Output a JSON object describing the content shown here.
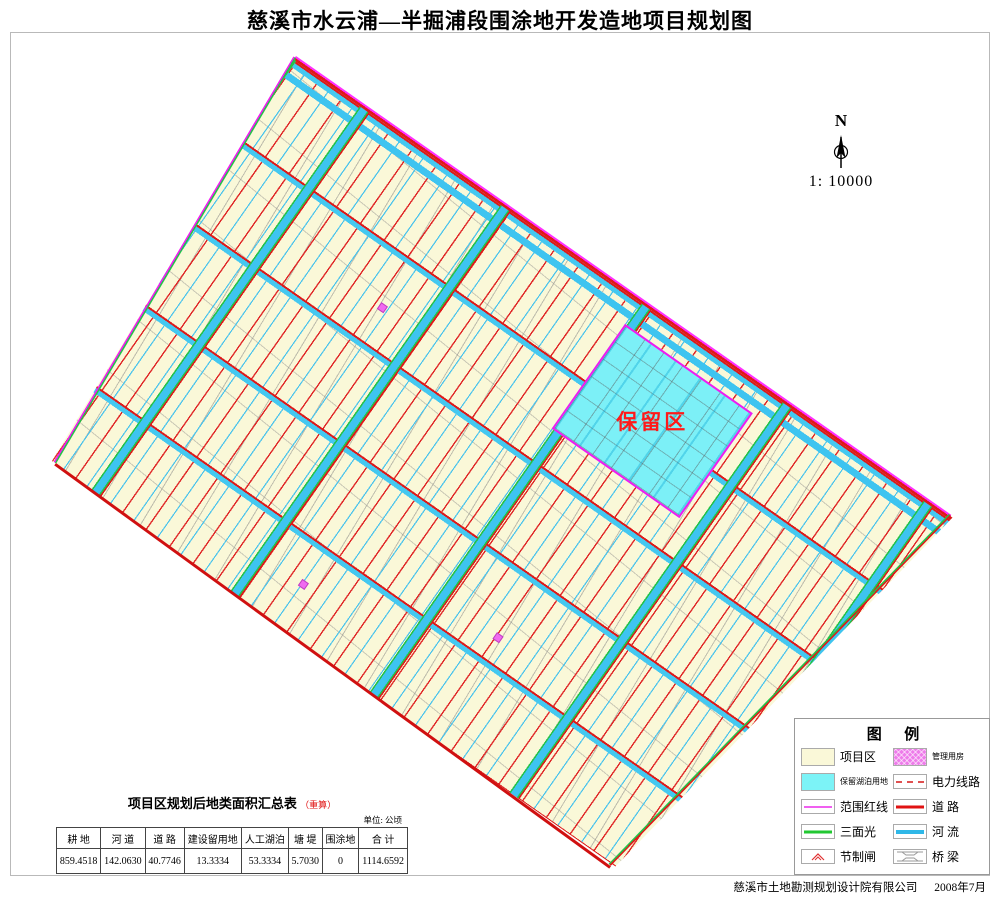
{
  "title": "慈溪市水云浦—半掘浦段围涂地开发造地项目规划图",
  "map": {
    "north_label": "N",
    "scale_text": "1: 10000",
    "reserved_area_label": "保留区",
    "colors": {
      "project_area_fill": "#faf8d8",
      "reserved_area_fill": "#7cf0f7",
      "road_line": "#e01212",
      "river_line": "#2fb8e8",
      "range_red_line": "#f060f0",
      "three_side_line": "#22c832",
      "power_line": "#e05050",
      "management_house": "#ee7bea"
    }
  },
  "legend": {
    "title": "图      例",
    "items": [
      {
        "label": "项目区",
        "type": "area-project"
      },
      {
        "label": "管理用房",
        "type": "area-house"
      },
      {
        "label": "保留湖泊用地",
        "type": "area-lake"
      },
      {
        "label": "电力线路",
        "type": "line-power"
      },
      {
        "label": "范围红线",
        "type": "line-range"
      },
      {
        "label": "道 路",
        "type": "line-road"
      },
      {
        "label": "三面光",
        "type": "line-green"
      },
      {
        "label": "河 流",
        "type": "line-river"
      },
      {
        "label": "节制闸",
        "type": "symbol-gate"
      },
      {
        "label": "桥 梁",
        "type": "symbol-bridge"
      }
    ]
  },
  "summary_table": {
    "title": "项目区规划后地类面积汇总表",
    "title_note": "（重算）",
    "unit": "单位: 公顷",
    "columns": [
      "耕 地",
      "河 道",
      "道 路",
      "建设留用地",
      "人工湖泊",
      "塘 堤",
      "围涂地",
      "合 计"
    ],
    "values": [
      "859.4518",
      "142.0630",
      "40.7746",
      "13.3334",
      "53.3334",
      "5.7030",
      "0",
      "1114.6592"
    ]
  },
  "footer": {
    "company": "慈溪市土地勘测规划设计院有限公司",
    "date": "2008年7月"
  }
}
